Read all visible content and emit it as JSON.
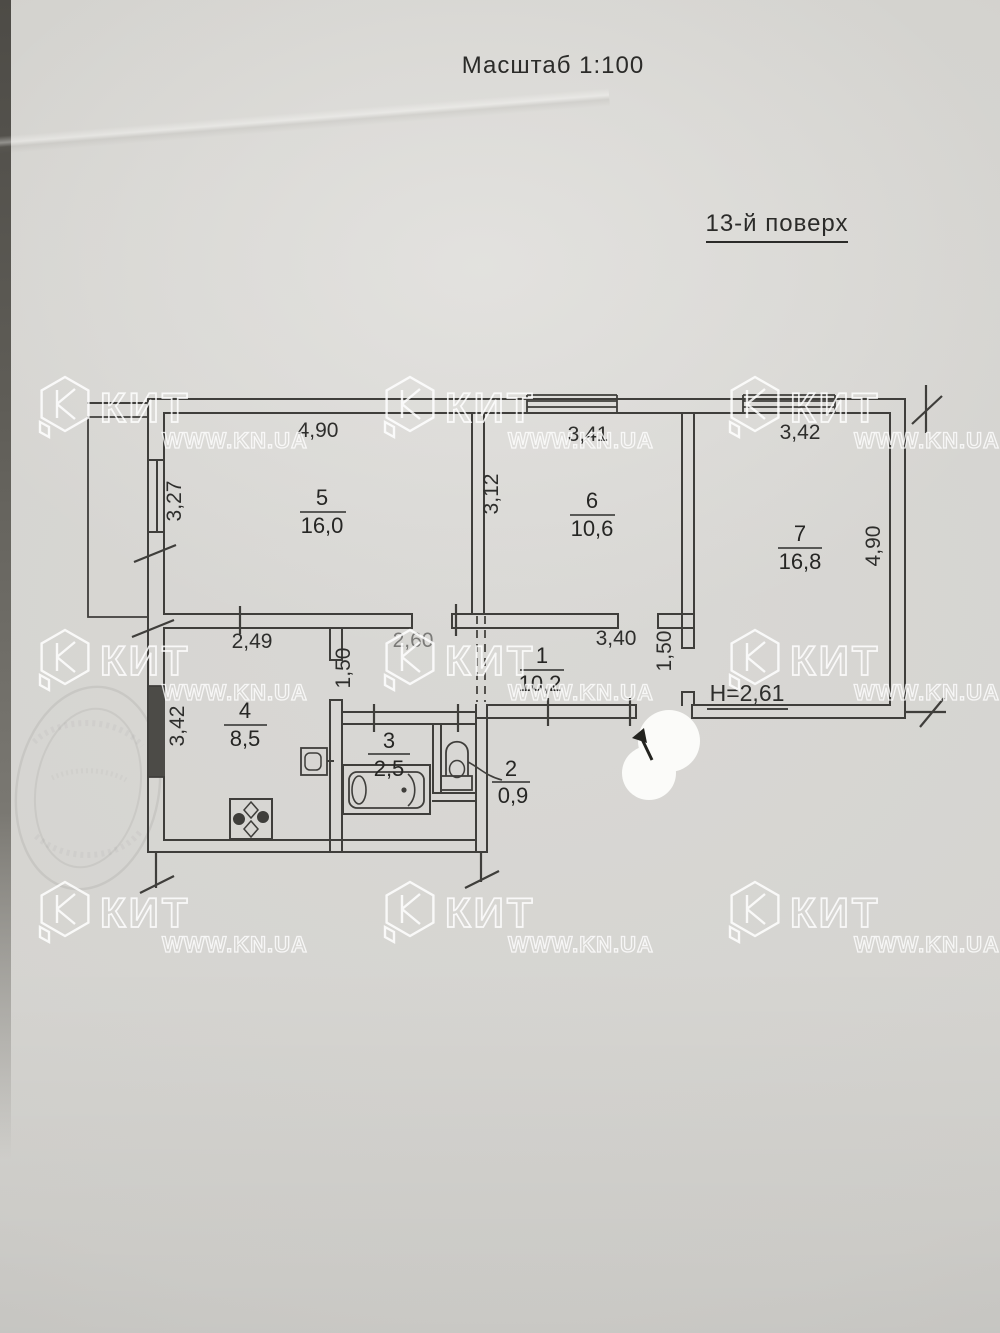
{
  "page": {
    "scale_title": "Масштаб 1:100",
    "floor_label": "13-й поверх"
  },
  "watermark": {
    "brand": "КИТ",
    "site": "WWW.KN.UA"
  },
  "plan": {
    "ceiling_height": "Н=2,61",
    "rooms": [
      {
        "number": "1",
        "area": "10,2"
      },
      {
        "number": "2",
        "area": "0,9"
      },
      {
        "number": "3",
        "area": "2,5"
      },
      {
        "number": "4",
        "area": "8,5"
      },
      {
        "number": "5",
        "area": "16,0"
      },
      {
        "number": "6",
        "area": "10,6"
      },
      {
        "number": "7",
        "area": "16,8"
      }
    ],
    "dimensions": {
      "room5_width": "4,90",
      "room5_depth": "3,27",
      "room6_width": "3,41",
      "room6_depth": "3,12",
      "room7_width": "3,42",
      "room7_depth": "4,90",
      "kitchen_width": "2,49",
      "kitchen_depth": "3,42",
      "hall_segment_a": "2,60",
      "hall_segment_b": "3,40",
      "hall_width_a": "1,50",
      "hall_width_b": "1,50"
    }
  }
}
